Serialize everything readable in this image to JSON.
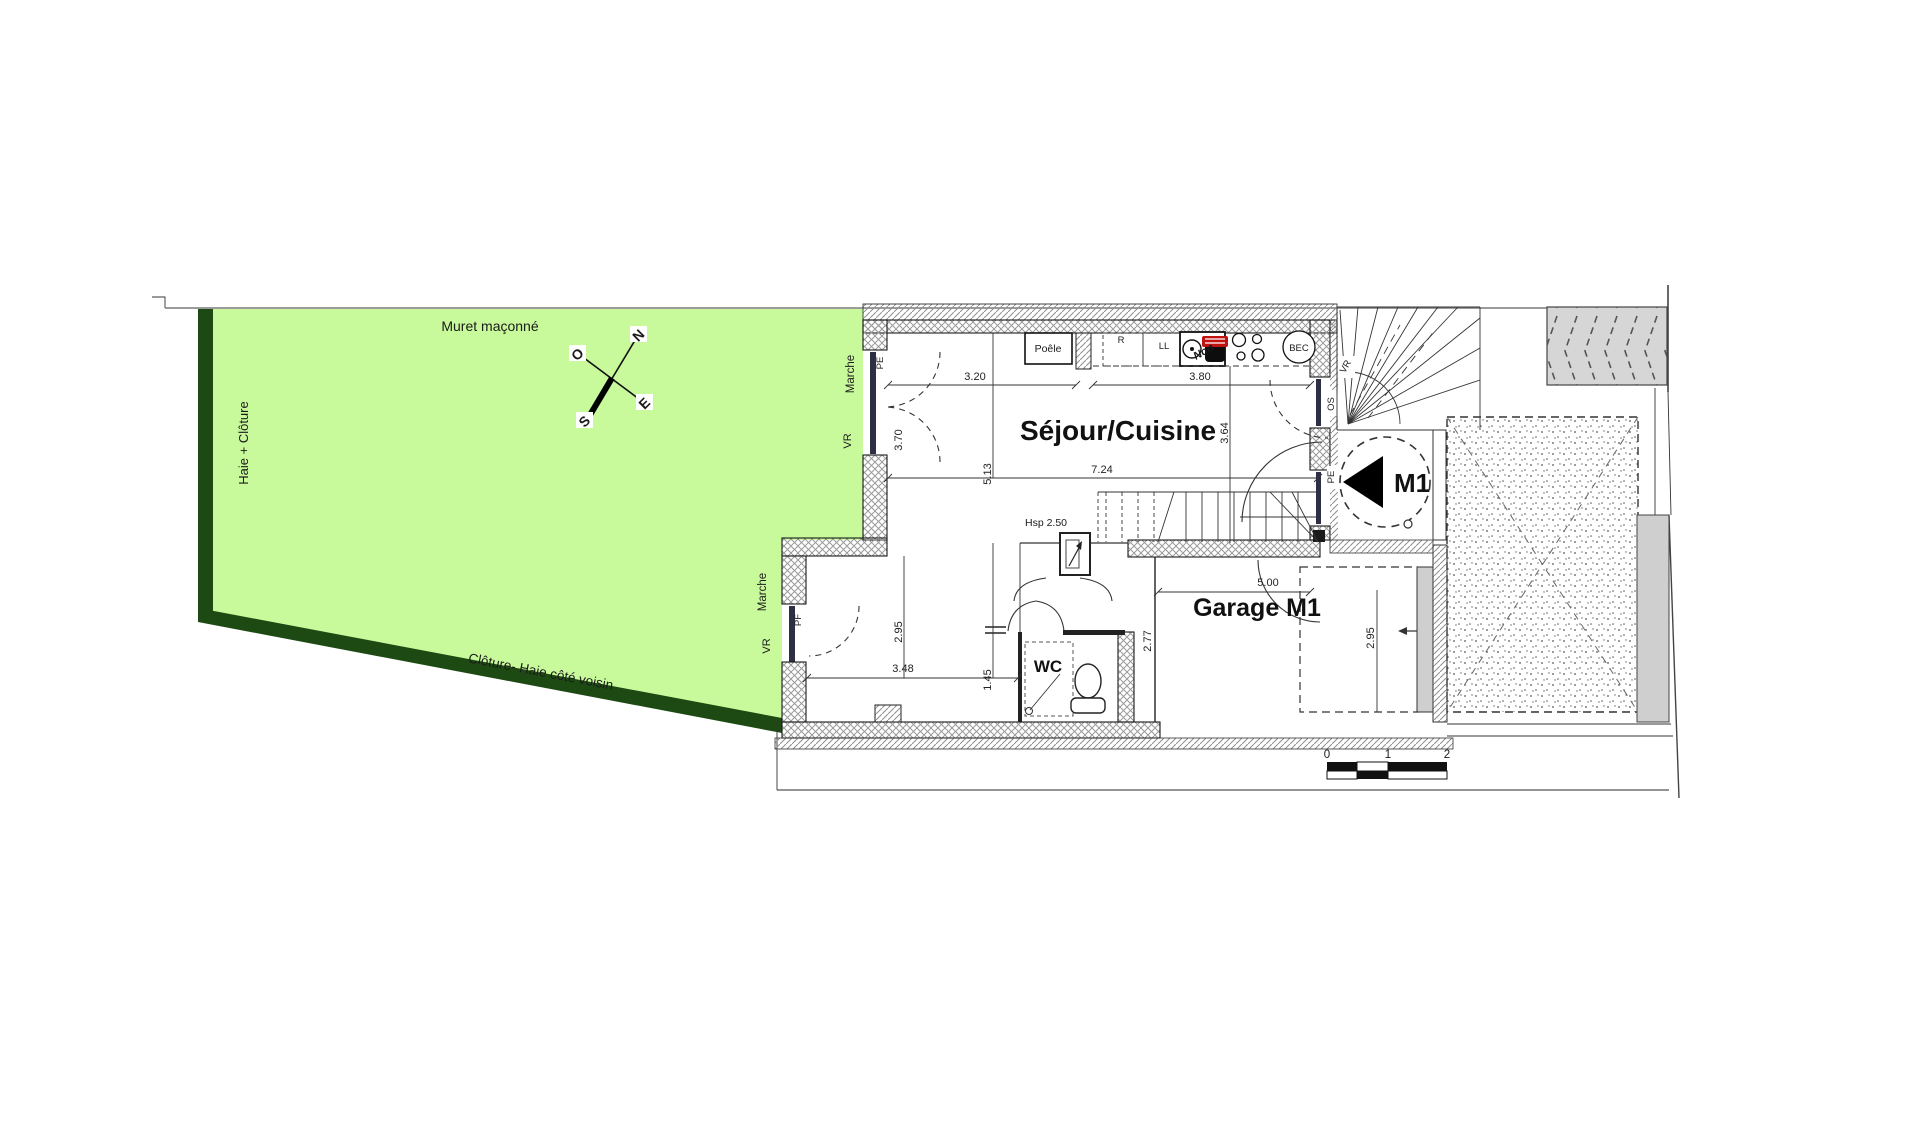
{
  "site": {
    "muret": "Muret maçonné",
    "haie_cloture": "Haie + Clôture",
    "cloture_voisin": "Clôture- Haie  côté voisin",
    "marche_upper": "Marche",
    "vr_upper": "VR",
    "marche_lower": "Marche",
    "vr_lower": "VR"
  },
  "compass": {
    "n": "N",
    "s": "S",
    "e": "E",
    "o": "O"
  },
  "rooms": {
    "sejour": "Séjour/Cuisine",
    "garage": "Garage M1",
    "wc": "WC",
    "entrance_marker": "M1"
  },
  "kitchen": {
    "poele": "Poêle",
    "r": "R",
    "ll": "LL",
    "bec": "BEC",
    "stamp": "Non"
  },
  "openings": {
    "pe_left": "PE",
    "pf_left": "PF",
    "os_right": "OS",
    "pe_right": "PE",
    "vr_right": "VR",
    "pg_garage": "PG"
  },
  "dims": {
    "d320": "3.20",
    "d380": "3.80",
    "d370": "3.70",
    "d513": "5.13",
    "d724": "7.24",
    "d364": "3.64",
    "d295a": "2.95",
    "d348": "3.48",
    "d145": "1.45",
    "d277": "2.77",
    "d500": "5.00",
    "d295b": "2.95",
    "hsp": "Hsp 2.50"
  },
  "scale_bar": {
    "t0": "0",
    "t1": "1",
    "t2": "2"
  },
  "colors": {
    "garden": "#c8fa9b",
    "hedge": "#1c4a12",
    "paving": "#d6d6d6",
    "stamp": "#c11212"
  }
}
